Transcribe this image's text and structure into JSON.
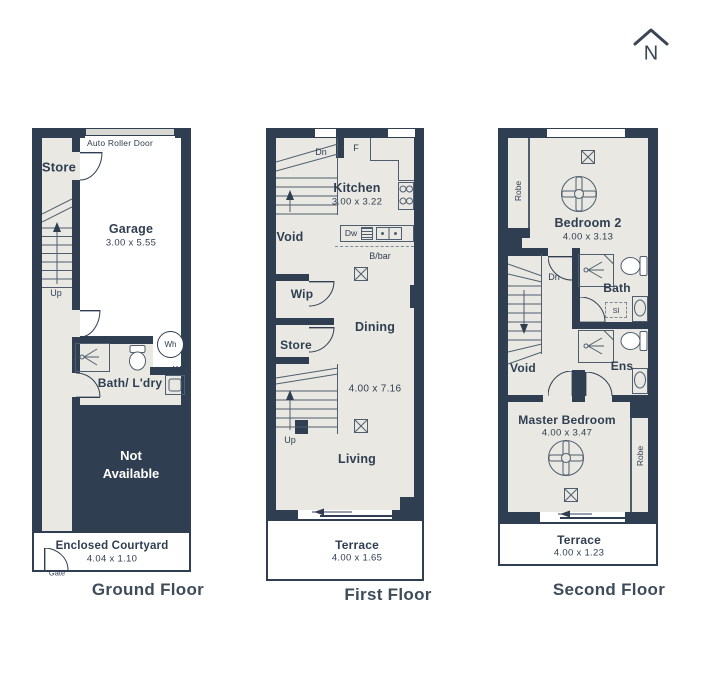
{
  "colors": {
    "wall": "#2f3e50",
    "floor": "#e9e8e2",
    "line": "#4e5e6e",
    "roller": "#d8d8d3"
  },
  "compass": {
    "letter": "N"
  },
  "floors": {
    "ground": {
      "title": "Ground Floor",
      "rooms": {
        "store": {
          "name": "Store"
        },
        "garage": {
          "name": "Garage",
          "dims": "3.00 x 5.55"
        },
        "bath": {
          "name": "Bath/ L'dry"
        },
        "not_available": {
          "name": "Not Available"
        },
        "courtyard": {
          "name": "Enclosed Courtyard",
          "dims": "4.04 x 1.10"
        }
      },
      "labels": {
        "auto_roller_door": "Auto Roller Door",
        "up": "Up",
        "wh": "Wh",
        "w": "W",
        "gate": "Gate"
      }
    },
    "first": {
      "title": "First Floor",
      "rooms": {
        "kitchen": {
          "name": "Kitchen",
          "dims": "3.00 x 3.22"
        },
        "void": {
          "name": "Void"
        },
        "wip": {
          "name": "Wip"
        },
        "store": {
          "name": "Store"
        },
        "dining": {
          "name": "Dining"
        },
        "living": {
          "name": "Living"
        },
        "open_plan_dims": "4.00 x 7.16",
        "terrace": {
          "name": "Terrace",
          "dims": "4.00 x 1.65"
        }
      },
      "labels": {
        "dn": "Dn",
        "f": "F",
        "dw": "Dw",
        "bbar": "B/bar",
        "up": "Up"
      }
    },
    "second": {
      "title": "Second Floor",
      "rooms": {
        "bedroom2": {
          "name": "Bedroom 2",
          "dims": "4.00 x 3.13"
        },
        "bath": {
          "name": "Bath"
        },
        "ens": {
          "name": "Ens"
        },
        "void": {
          "name": "Void"
        },
        "master": {
          "name": "Master Bedroom",
          "dims": "4.00 x 3.47"
        },
        "terrace": {
          "name": "Terrace",
          "dims": "4.00 x 1.23"
        }
      },
      "labels": {
        "robe_left": "Robe",
        "robe_right": "Robe",
        "dn": "Dn",
        "sl": "Sl"
      }
    }
  }
}
